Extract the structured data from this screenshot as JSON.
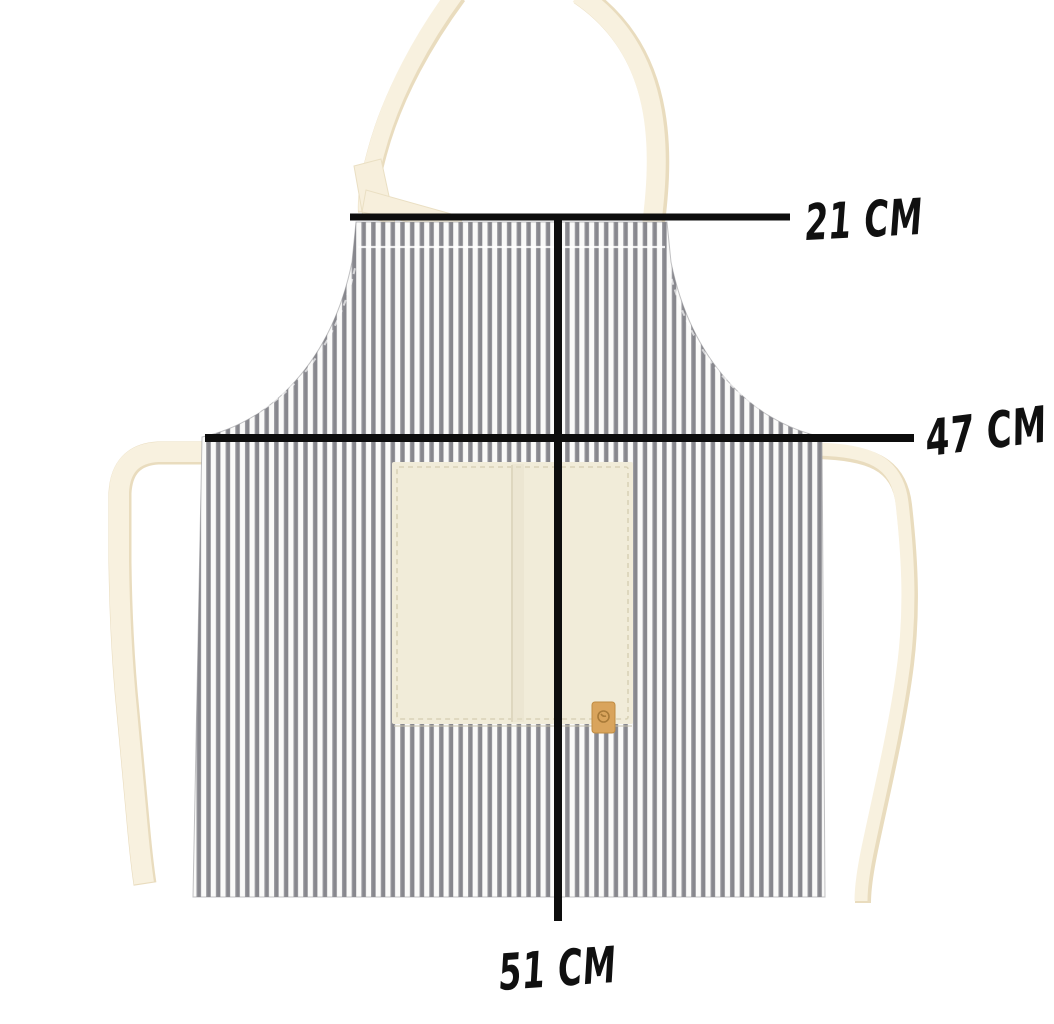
{
  "image": {
    "type": "product-dimension-diagram",
    "subject": "Grey-and-white pinstriped bib apron with cream neck strap, cream waist ties, and a cream front pocket with small leather tag",
    "background": "#ffffff"
  },
  "measurements": [
    {
      "id": "top-width",
      "label": "21 CM",
      "value": 21,
      "unit": "CM",
      "measures": "bib top width",
      "orientation": "horizontal"
    },
    {
      "id": "waist-width",
      "label": "47 CM",
      "value": 47,
      "unit": "CM",
      "measures": "waist width",
      "orientation": "horizontal"
    },
    {
      "id": "length",
      "label": "51 CM",
      "value": 51,
      "unit": "CM",
      "measures": "skirt length",
      "orientation": "vertical"
    }
  ],
  "colors": {
    "stripe": "#87878d",
    "stripe_background": "#fafaf9",
    "strap_cream": "#f8f1df",
    "strap_shadow": "#e9dcbe",
    "pocket": "#f1ecd9",
    "pocket_stitch": "#d9d2b7",
    "tag": "#d9a45c",
    "tag_emblem": "#a87a38",
    "dimension_line": "#0d0d0d",
    "label_text": "#101010"
  }
}
